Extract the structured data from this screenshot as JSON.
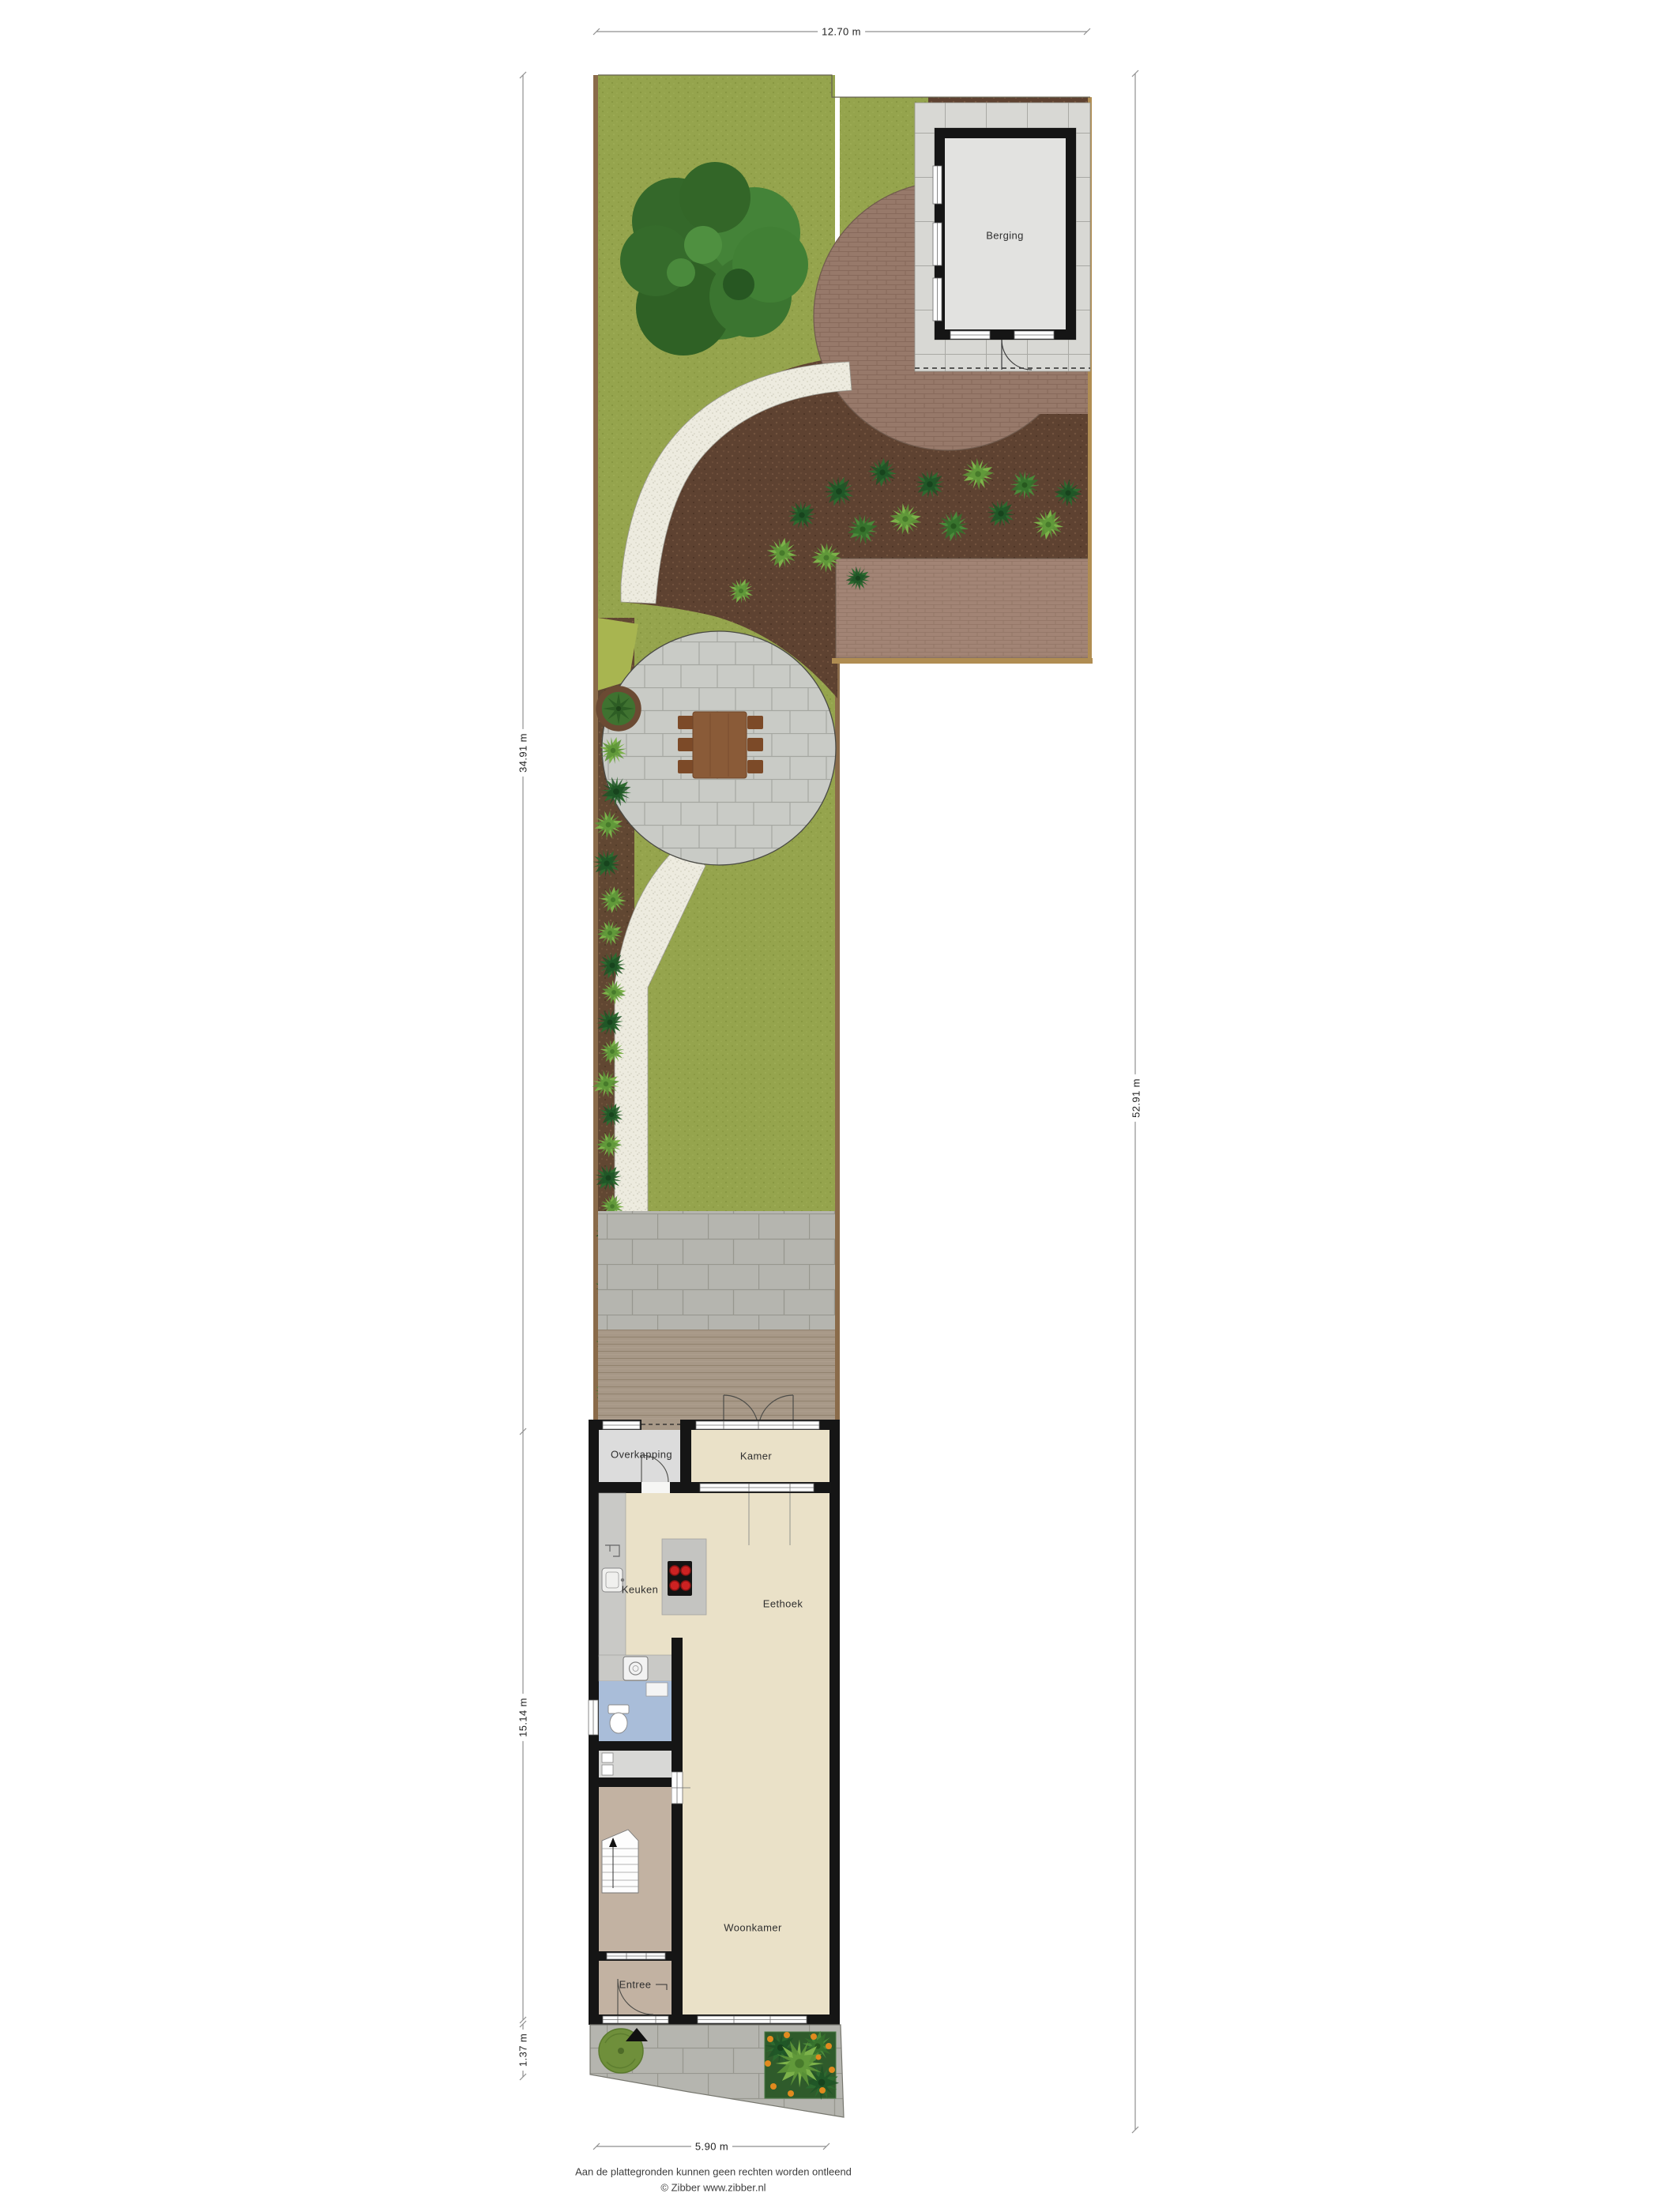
{
  "title": "Plattegrond begane grond met tuin",
  "dimensions": {
    "top": "12.70 m",
    "left_garden": "34.91 m",
    "left_house": "15.14 m",
    "left_front": "1.37 m",
    "right_total": "52.91 m",
    "bottom": "5.90 m"
  },
  "rooms": {
    "berging": "Berging",
    "overkapping": "Overkapping",
    "kamer": "Kamer",
    "keuken": "Keuken",
    "eethoek": "Eethoek",
    "woonkamer": "Woonkamer",
    "entree": "Entree"
  },
  "footer": {
    "line1": "Aan de plattegronden kunnen geen rechten worden ontleend",
    "line2": "© Zibber www.zibber.nl"
  },
  "symbols": [
    "tree-icon",
    "shrub-icon",
    "dining-table-icon",
    "cooktop-icon",
    "sink-icon",
    "toilet-icon",
    "washer-icon",
    "stairs-icon",
    "north-arrow-icon",
    "flower-bed-icon",
    "door-swing-icon",
    "window-icon"
  ],
  "colors": {
    "grass": "#95a44d",
    "mulch": "#5e4231",
    "gravel": "#edebdf",
    "brick": "#97796a",
    "brick_light": "#a28475",
    "slab_paving": "#d8d8d4",
    "block_paving": "#b5b5af",
    "deck": "#a79887",
    "patio": "#c9cbc6",
    "wall": "#151515",
    "floor_cream": "#eae1c8",
    "floor_gray": "#dcdcdc",
    "floor_blue": "#a9bdd9",
    "floor_hall": "#c2b2a2",
    "shed_floor": "#e2e2e0",
    "burner_red": "#cc2222",
    "flower_orange": "#e08a1e"
  }
}
